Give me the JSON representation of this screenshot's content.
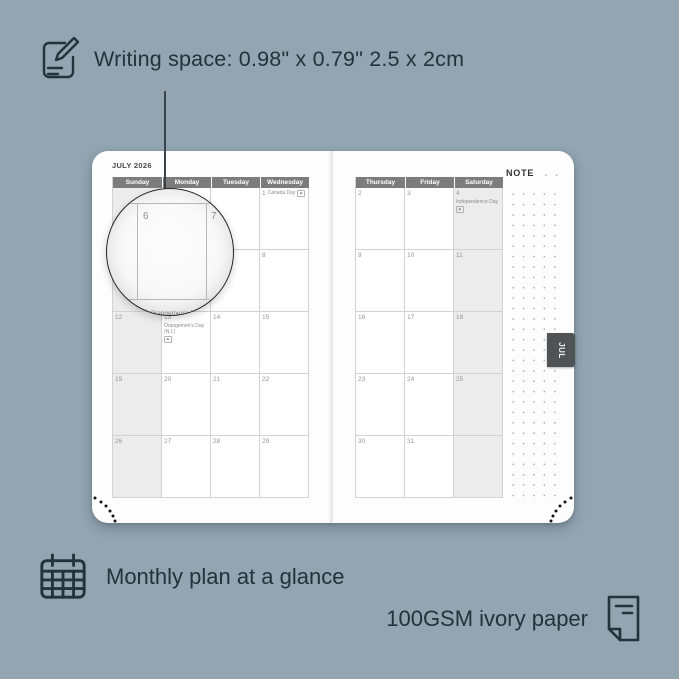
{
  "colors": {
    "background": "#92a5b1",
    "annotation_text": "#24323c",
    "page": "#fdfdfd",
    "header_bar": "#7c7c7c",
    "weekend_shade": "#ececec",
    "tab": "#4f5356"
  },
  "annotations": {
    "top": {
      "icon": "pencil-note-icon",
      "text": "Writing space: 0.98\" x 0.79\"  2.5 x 2cm"
    },
    "bottom_left": {
      "icon": "calendar-grid-icon",
      "text": "Monthly plan at a glance"
    },
    "bottom_right": {
      "icon": "paper-sheet-icon",
      "text": "100GSM ivory paper"
    }
  },
  "planner": {
    "month_title": "JULY 2026",
    "note_label": "NOTE",
    "tab_label": "JUL",
    "left_page": {
      "day_headers": [
        "Sunday",
        "Monday",
        "Tuesday",
        "Wednesday"
      ],
      "weeks": [
        [
          {},
          {},
          {},
          {
            "d": "1",
            "h": "Canada Day",
            "flag": true
          }
        ],
        [
          {
            "d": "5"
          },
          {
            "d": "6"
          },
          {
            "d": "7"
          },
          {
            "d": "8"
          }
        ],
        [
          {
            "d": "12"
          },
          {
            "d": "13",
            "h": "Orangemen's Day (N.I.)",
            "flag": true
          },
          {
            "d": "14"
          },
          {
            "d": "15"
          }
        ],
        [
          {
            "d": "19"
          },
          {
            "d": "20"
          },
          {
            "d": "21"
          },
          {
            "d": "22"
          }
        ],
        [
          {
            "d": "26"
          },
          {
            "d": "27"
          },
          {
            "d": "28"
          },
          {
            "d": "29"
          }
        ]
      ]
    },
    "right_page": {
      "day_headers": [
        "Thursday",
        "Friday",
        "Saturday"
      ],
      "weeks": [
        [
          {
            "d": "2"
          },
          {
            "d": "3"
          },
          {
            "d": "4",
            "h": "Independence Day",
            "flag": true
          }
        ],
        [
          {
            "d": "9"
          },
          {
            "d": "10"
          },
          {
            "d": "11"
          }
        ],
        [
          {
            "d": "16"
          },
          {
            "d": "17"
          },
          {
            "d": "18"
          }
        ],
        [
          {
            "d": "23"
          },
          {
            "d": "24"
          },
          {
            "d": "25"
          }
        ],
        [
          {
            "d": "30"
          },
          {
            "d": "31"
          },
          {}
        ]
      ]
    },
    "magnifier": {
      "date_left": "6",
      "date_right": "7",
      "holiday_date": "13",
      "holiday_name": "Orangemen's Day",
      "holiday_region": "(N.I.)"
    }
  }
}
